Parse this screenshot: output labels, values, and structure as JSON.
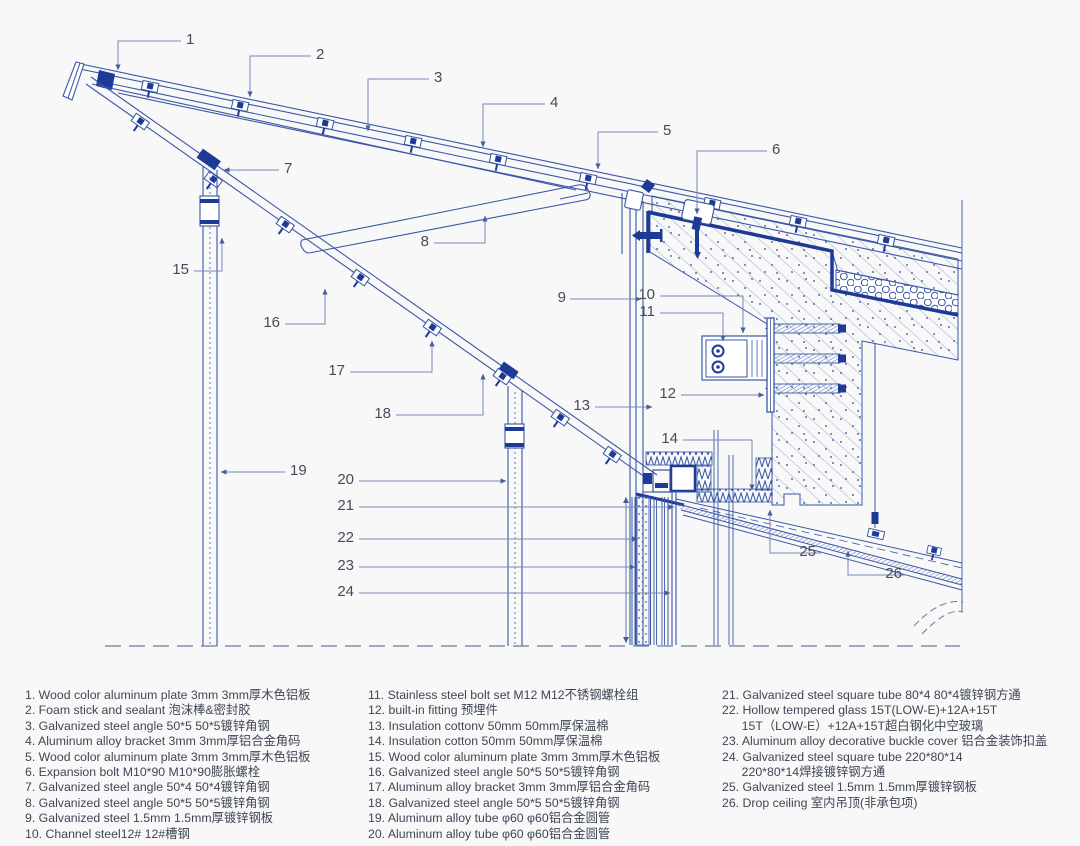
{
  "drawing": {
    "type": "architectural-section-detail",
    "callouts": [
      "1",
      "2",
      "3",
      "4",
      "5",
      "6",
      "7",
      "8",
      "9",
      "10",
      "11",
      "12",
      "13",
      "14",
      "15",
      "16",
      "17",
      "18",
      "19",
      "20",
      "21",
      "22",
      "23",
      "24",
      "25",
      "26"
    ]
  },
  "colors": {
    "line_blue": "#3352a3",
    "dark_blue": "#1d3a96",
    "leader": "#7389b8",
    "text": "#454b59",
    "background": "#f8f8f9"
  },
  "legend": {
    "columns": [
      {
        "items": [
          "1. Wood color aluminum plate 3mm  3mm厚木色铝板",
          "2. Foam stick and sealant  泡沫棒&密封胶",
          "3. Galvanized steel angle 50*5  50*5镀锌角钢",
          "4. Aluminum alloy bracket 3mm  3mm厚铝合金角码",
          "5. Wood color aluminum plate 3mm  3mm厚木色铝板",
          "6. Expansion bolt M10*90  M10*90膨胀螺栓",
          "7. Galvanized steel angle 50*4  50*4镀锌角钢",
          "8. Galvanized steel angle 50*5  50*5镀锌角钢",
          "9. Galvanized steel 1.5mm  1.5mm厚镀锌钢板",
          "10. Channel steel12#  12#槽钢"
        ]
      },
      {
        "items": [
          "11. Stainless steel bolt set M12  M12不锈钢螺栓组",
          "12. built-in fitting  预埋件",
          "13. Insulation cottonv 50mm  50mm厚保温棉",
          "14. Insulation cotton 50mm  50mm厚保温棉",
          "15. Wood color aluminum plate 3mm  3mm厚木色铝板",
          "16. Galvanized steel angle 50*5  50*5镀锌角钢",
          "17. Aluminum alloy bracket 3mm  3mm厚铝合金角码",
          "18. Galvanized steel angle 50*5  50*5镀锌角钢",
          "19. Aluminum alloy tube φ60  φ60铝合金圆管",
          "20. Aluminum alloy tube φ60  φ60铝合金圆管"
        ]
      },
      {
        "items": [
          "21. Galvanized steel square tube 80*4  80*4镀锌钢方通",
          "22. Hollow tempered glass 15T(LOW-E)+12A+15T\n15T（LOW-E）+12A+15T超白钢化中空玻璃",
          "23. Aluminum alloy decorative buckle cover  铝合金装饰扣盖",
          "24. Galvanized steel square tube 220*80*14\n220*80*14焊接镀锌钢方通",
          "25. Galvanized steel 1.5mm  1.5mm厚镀锌钢板",
          "26. Drop ceiling  室内吊顶(非承包项)"
        ]
      }
    ]
  }
}
